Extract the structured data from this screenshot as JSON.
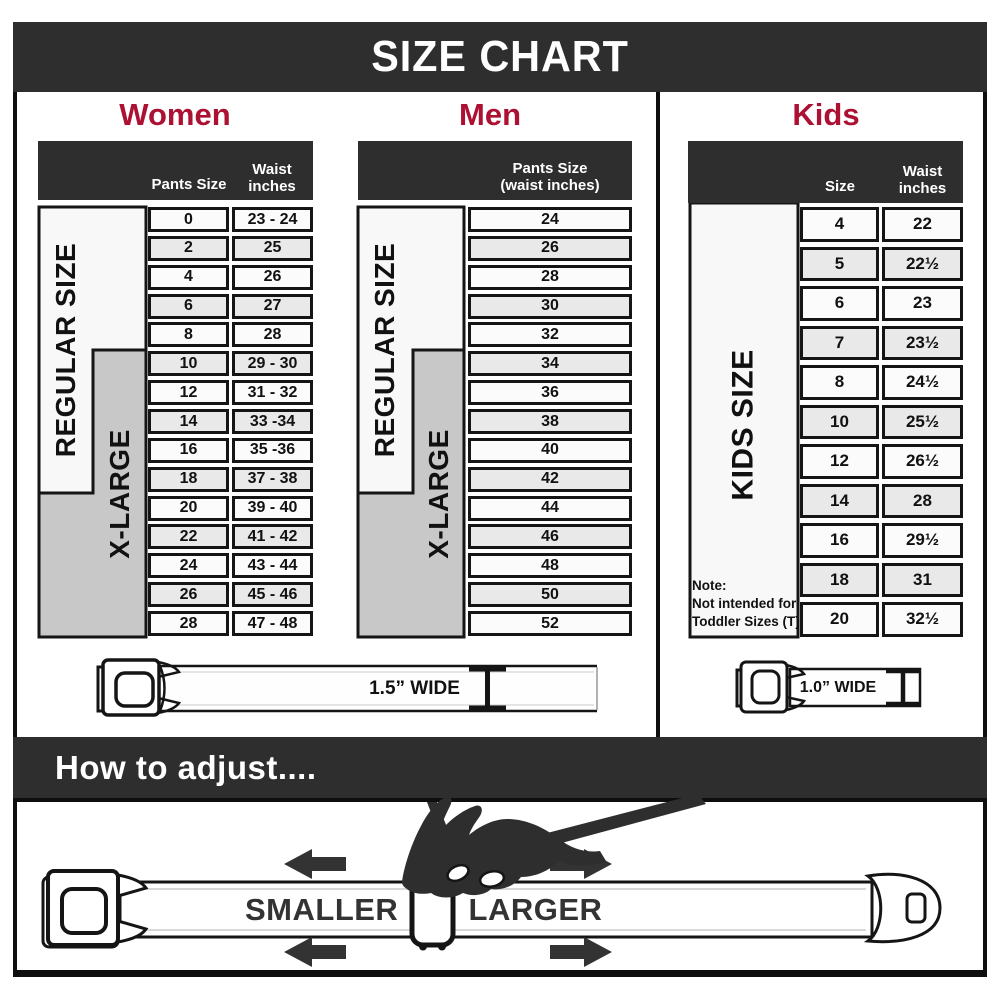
{
  "title": "SIZE CHART",
  "accent_color": "#AC1032",
  "bar_color": "#2E2E2E",
  "sections": {
    "women": {
      "label": "Women",
      "regular_label": "REGULAR SIZE",
      "xlarge_label": "X-LARGE",
      "col_size_header": "Pants Size",
      "col_waist_header_line1": "Waist",
      "col_waist_header_line2": "inches",
      "rows": [
        {
          "size": "0",
          "waist": "23 - 24"
        },
        {
          "size": "2",
          "waist": "25"
        },
        {
          "size": "4",
          "waist": "26"
        },
        {
          "size": "6",
          "waist": "27"
        },
        {
          "size": "8",
          "waist": "28"
        },
        {
          "size": "10",
          "waist": "29 - 30"
        },
        {
          "size": "12",
          "waist": "31 - 32"
        },
        {
          "size": "14",
          "waist": "33 -34"
        },
        {
          "size": "16",
          "waist": "35 -36"
        },
        {
          "size": "18",
          "waist": "37 - 38"
        },
        {
          "size": "20",
          "waist": "39 - 40"
        },
        {
          "size": "22",
          "waist": "41 - 42"
        },
        {
          "size": "24",
          "waist": "43 - 44"
        },
        {
          "size": "26",
          "waist": "45 - 46"
        },
        {
          "size": "28",
          "waist": "47 - 48"
        }
      ]
    },
    "men": {
      "label": "Men",
      "regular_label": "REGULAR SIZE",
      "xlarge_label": "X-LARGE",
      "header_line1": "Pants Size",
      "header_line2": "(waist inches)",
      "rows": [
        "24",
        "26",
        "28",
        "30",
        "32",
        "34",
        "36",
        "38",
        "40",
        "42",
        "44",
        "46",
        "48",
        "50",
        "52"
      ]
    },
    "kids": {
      "label": "Kids",
      "size_label": "KIDS SIZE",
      "col_size_header": "Size",
      "col_waist_header_line1": "Waist",
      "col_waist_header_line2": "inches",
      "rows": [
        {
          "size": "4",
          "waist": "22"
        },
        {
          "size": "5",
          "waist": "22½"
        },
        {
          "size": "6",
          "waist": "23"
        },
        {
          "size": "7",
          "waist": "23½"
        },
        {
          "size": "8",
          "waist": "24½"
        },
        {
          "size": "10",
          "waist": "25½"
        },
        {
          "size": "12",
          "waist": "26½"
        },
        {
          "size": "14",
          "waist": "28"
        },
        {
          "size": "16",
          "waist": "29½"
        },
        {
          "size": "18",
          "waist": "31"
        },
        {
          "size": "20",
          "waist": "32½"
        }
      ],
      "note_line1": "Note:",
      "note_line2": "Not intended for",
      "note_line3": "Toddler Sizes (T)"
    }
  },
  "belts": {
    "adult_width_label": "1.5” WIDE",
    "kids_width_label": "1.0” WIDE"
  },
  "adjust": {
    "title": "How to adjust....",
    "smaller_label": "SMALLER",
    "larger_label": "LARGER"
  }
}
